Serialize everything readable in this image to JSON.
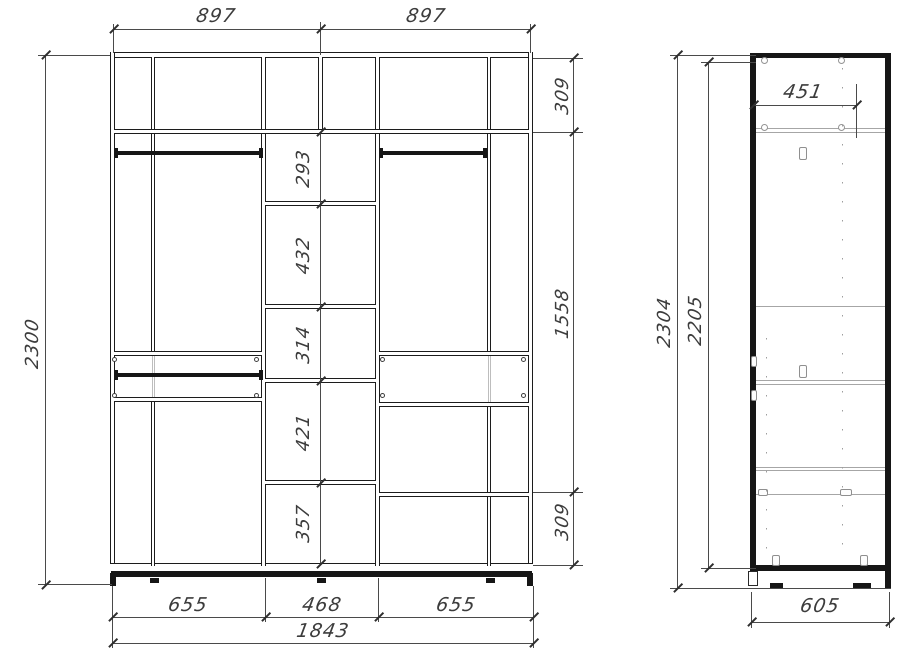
{
  "front_view": {
    "width_left": "897",
    "width_right": "897",
    "height_total": "2300",
    "right_top": "309",
    "right_middle": "1558",
    "right_bottom": "309",
    "center_sections": [
      "293",
      "432",
      "314",
      "421",
      "357"
    ],
    "bottom_left": "655",
    "bottom_center": "468",
    "bottom_right": "655",
    "width_total": "1843"
  },
  "side_view": {
    "height_overall": "2304",
    "height_panel": "2205",
    "depth_upper": "451",
    "depth_total": "605"
  },
  "colors": {
    "structure_line": "#1c1c1c",
    "dimension_line": "#4a4a4a",
    "hidden_detail": "#a6a6a6",
    "background": "#ffffff"
  }
}
